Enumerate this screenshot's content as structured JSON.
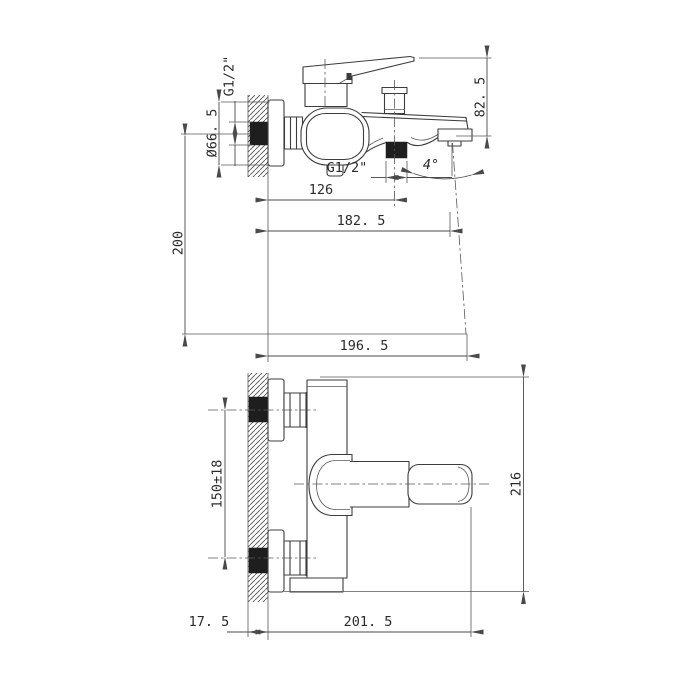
{
  "drawing": {
    "background": "#ffffff",
    "line_color": "#3c3c3c",
    "text_color": "#2b2b2b",
    "thread_fill": "#1e1e1e",
    "side_view": {
      "dim_wall_thread": "G1/2\"",
      "dim_escutcheon_diameter": "Ø66. 5",
      "dim_handle_height": "82. 5",
      "dim_diverter_thread": "G1/2\"",
      "dim_spout_angle": "4°",
      "dim_wall_to_diverter": "126",
      "dim_wall_to_outlet": "182. 5",
      "dim_outlet_drop": "200",
      "dim_wall_to_stream": "196. 5"
    },
    "front_view": {
      "dim_inlet_spacing": "150±18",
      "dim_overall_height": "216",
      "dim_wall_thickness": "17. 5",
      "dim_wall_to_handle_end": "201. 5"
    }
  }
}
